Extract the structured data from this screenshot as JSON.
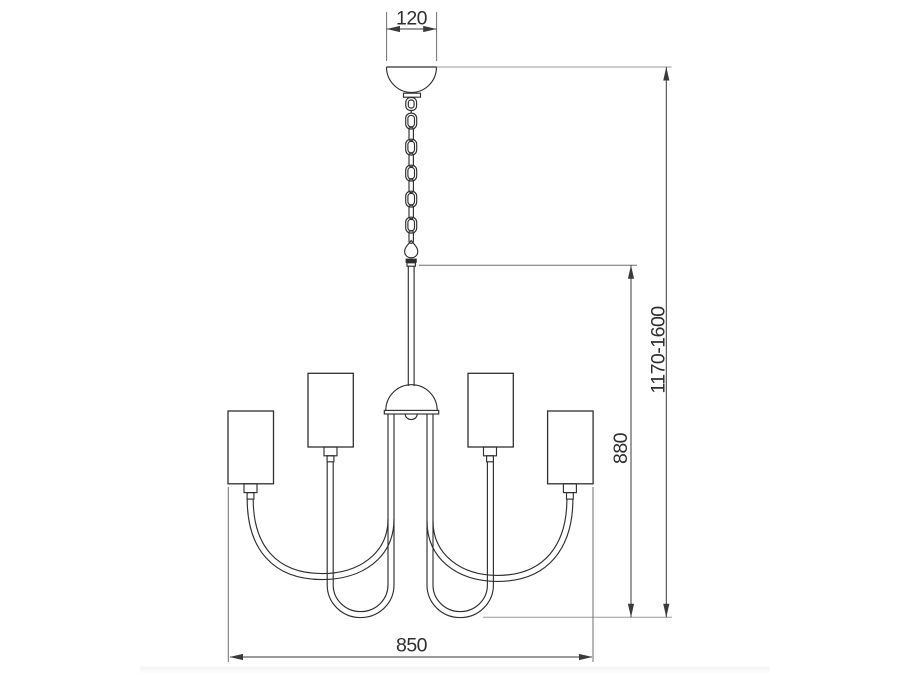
{
  "drawing": {
    "kind": "chandelier dimension diagram, front view",
    "shade_count": 4,
    "dimensions": {
      "canopy_width": "120",
      "overall_height_range": "1170-1600",
      "body_height": "880",
      "body_width": "850"
    },
    "colors": {
      "background": "#ffffff",
      "object_line": "#2f2f2f",
      "dimension_line": "#3a3a3a",
      "extension_line": "#9a9a9a",
      "text": "#2e2e2e"
    }
  }
}
